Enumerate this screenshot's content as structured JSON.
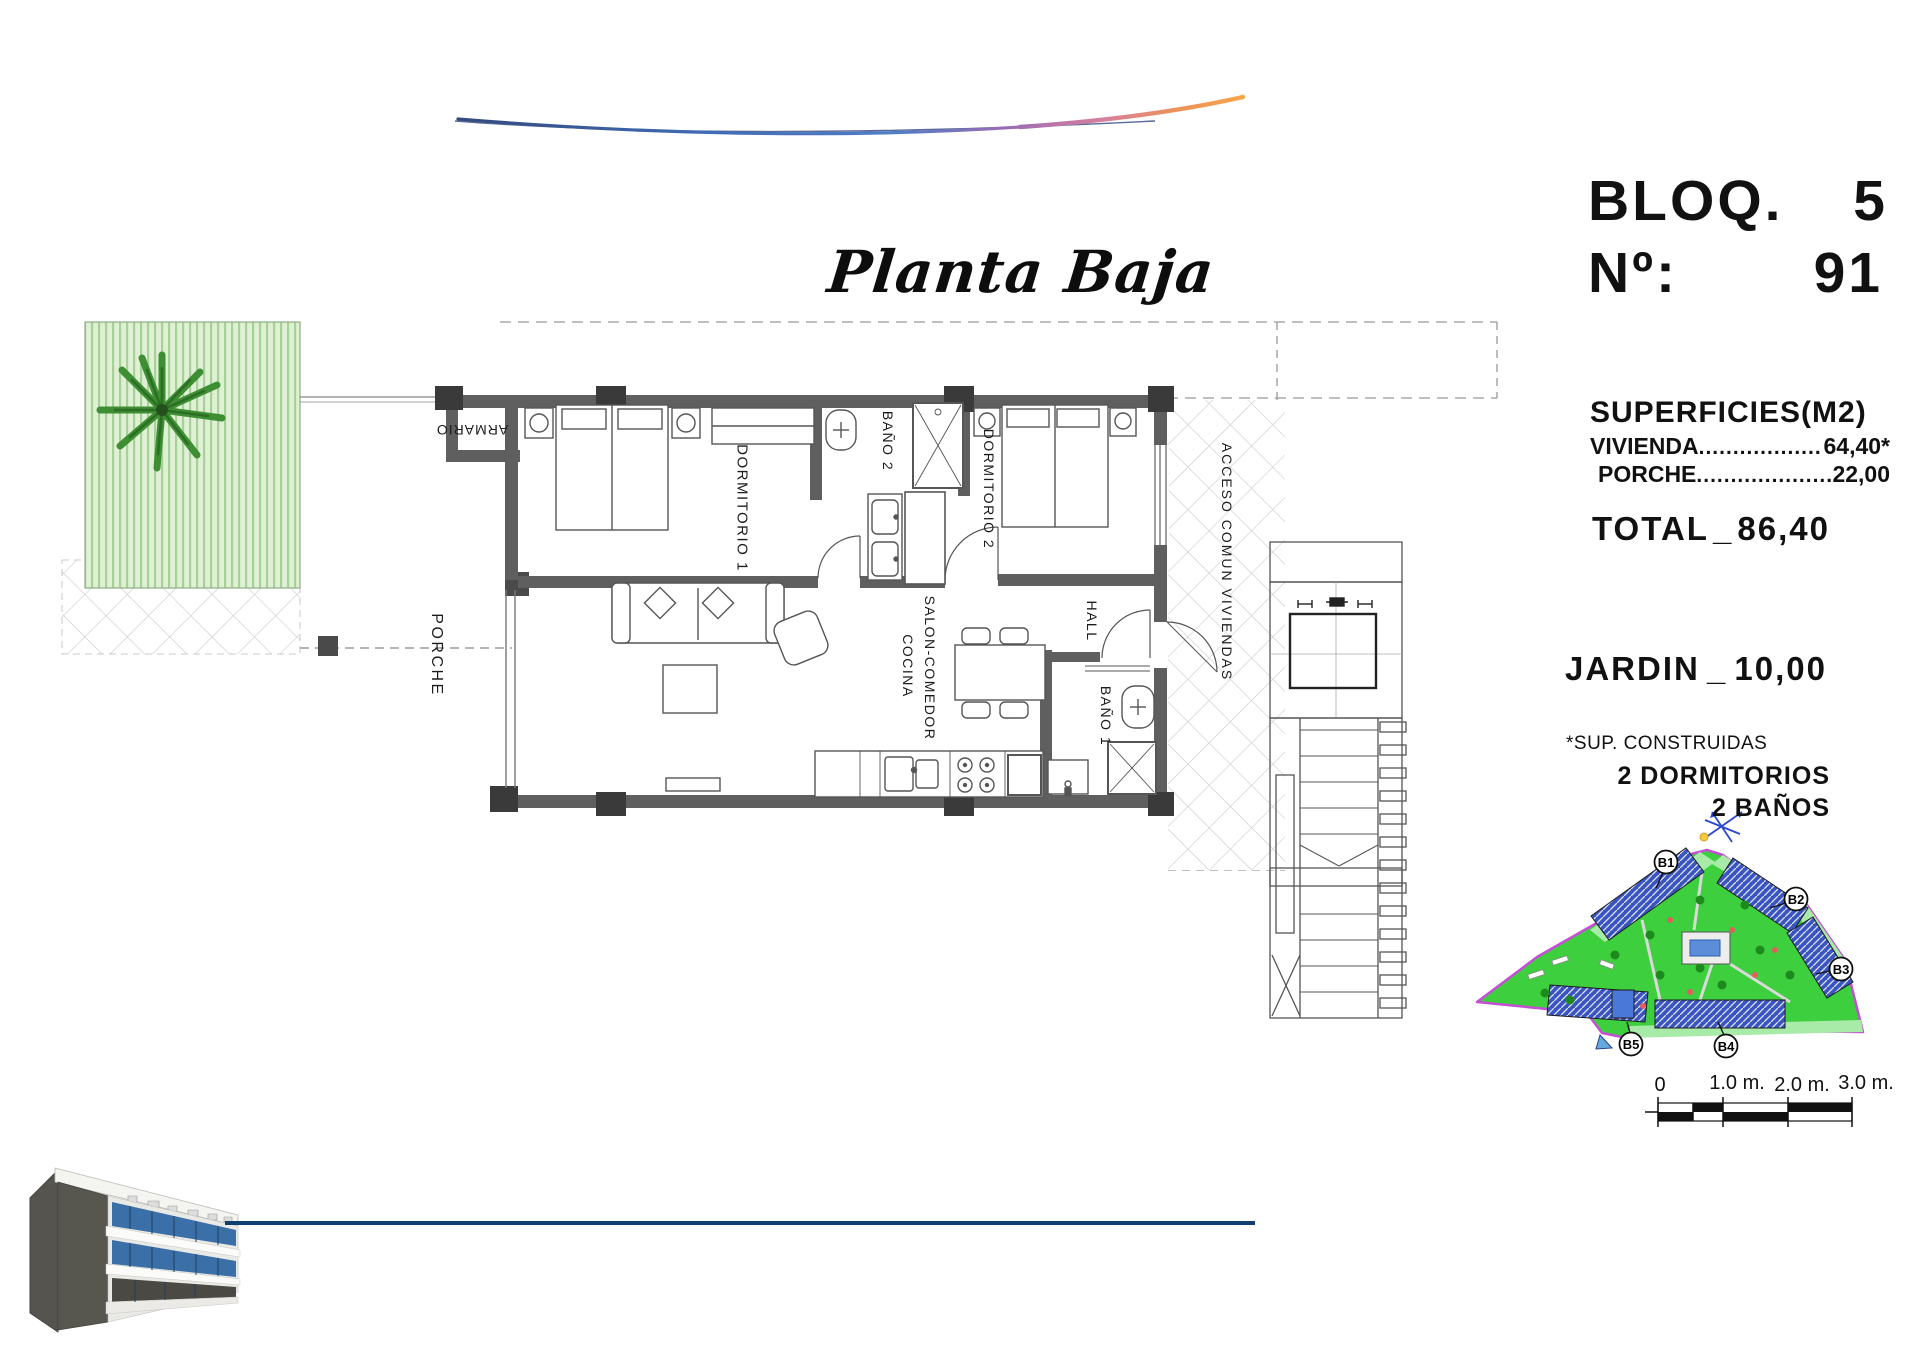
{
  "header": {
    "script_title": "Planta Baja"
  },
  "title_block": {
    "block_word": "BLOQ.",
    "block_number": "5",
    "unit_label": "Nº:",
    "unit_number": "91",
    "surfaces_heading": "SUPERFICIES(M2)",
    "surface_rows": [
      {
        "label": "VIVIENDA",
        "dots": "........................................",
        "value": "64,40*"
      },
      {
        "label": "PORCHE",
        "dots": "........................................",
        "value": "22,00"
      }
    ],
    "total_label": "TOTAL",
    "total_sep": "_",
    "total_value": "86,40",
    "jardin_label": "JARDIN",
    "jardin_sep": "_",
    "jardin_value": "10,00",
    "footnote": "*SUP. CONSTRUIDAS",
    "features": [
      "2 DORMITORIOS",
      "2 BAÑOS"
    ]
  },
  "plan": {
    "rooms": {
      "porche": "PORCHE",
      "armario": "ARMARIO",
      "dormitorio1": "DORMITORIO 1",
      "bano2": "BAÑO 2",
      "dormitorio2": "DORMITORIO 2",
      "hall": "HALL",
      "bano1": "BAÑO 1",
      "salon_comedor": "SALON-COMEDOR",
      "cocina": "COCINA",
      "acceso": "ACCESO COMUN VIVIENDAS"
    }
  },
  "site_plan": {
    "building_labels": [
      "B1",
      "B2",
      "B3",
      "B4",
      "B5"
    ]
  },
  "scale_bar": {
    "ticks": [
      "0",
      "1.0 m.",
      "2.0 m.",
      "3.0 m."
    ]
  },
  "colors": {
    "swoosh_blue": "#4a74c0",
    "swoosh_orange": "#f0964f",
    "bottom_line": "#11406e",
    "wall_gray": "#5f5f5f",
    "site_green": "#3dcf3d",
    "site_boundary": "#c44fd4",
    "garden_green": "#dff0d4",
    "window_blue": "#3a6fa8"
  }
}
